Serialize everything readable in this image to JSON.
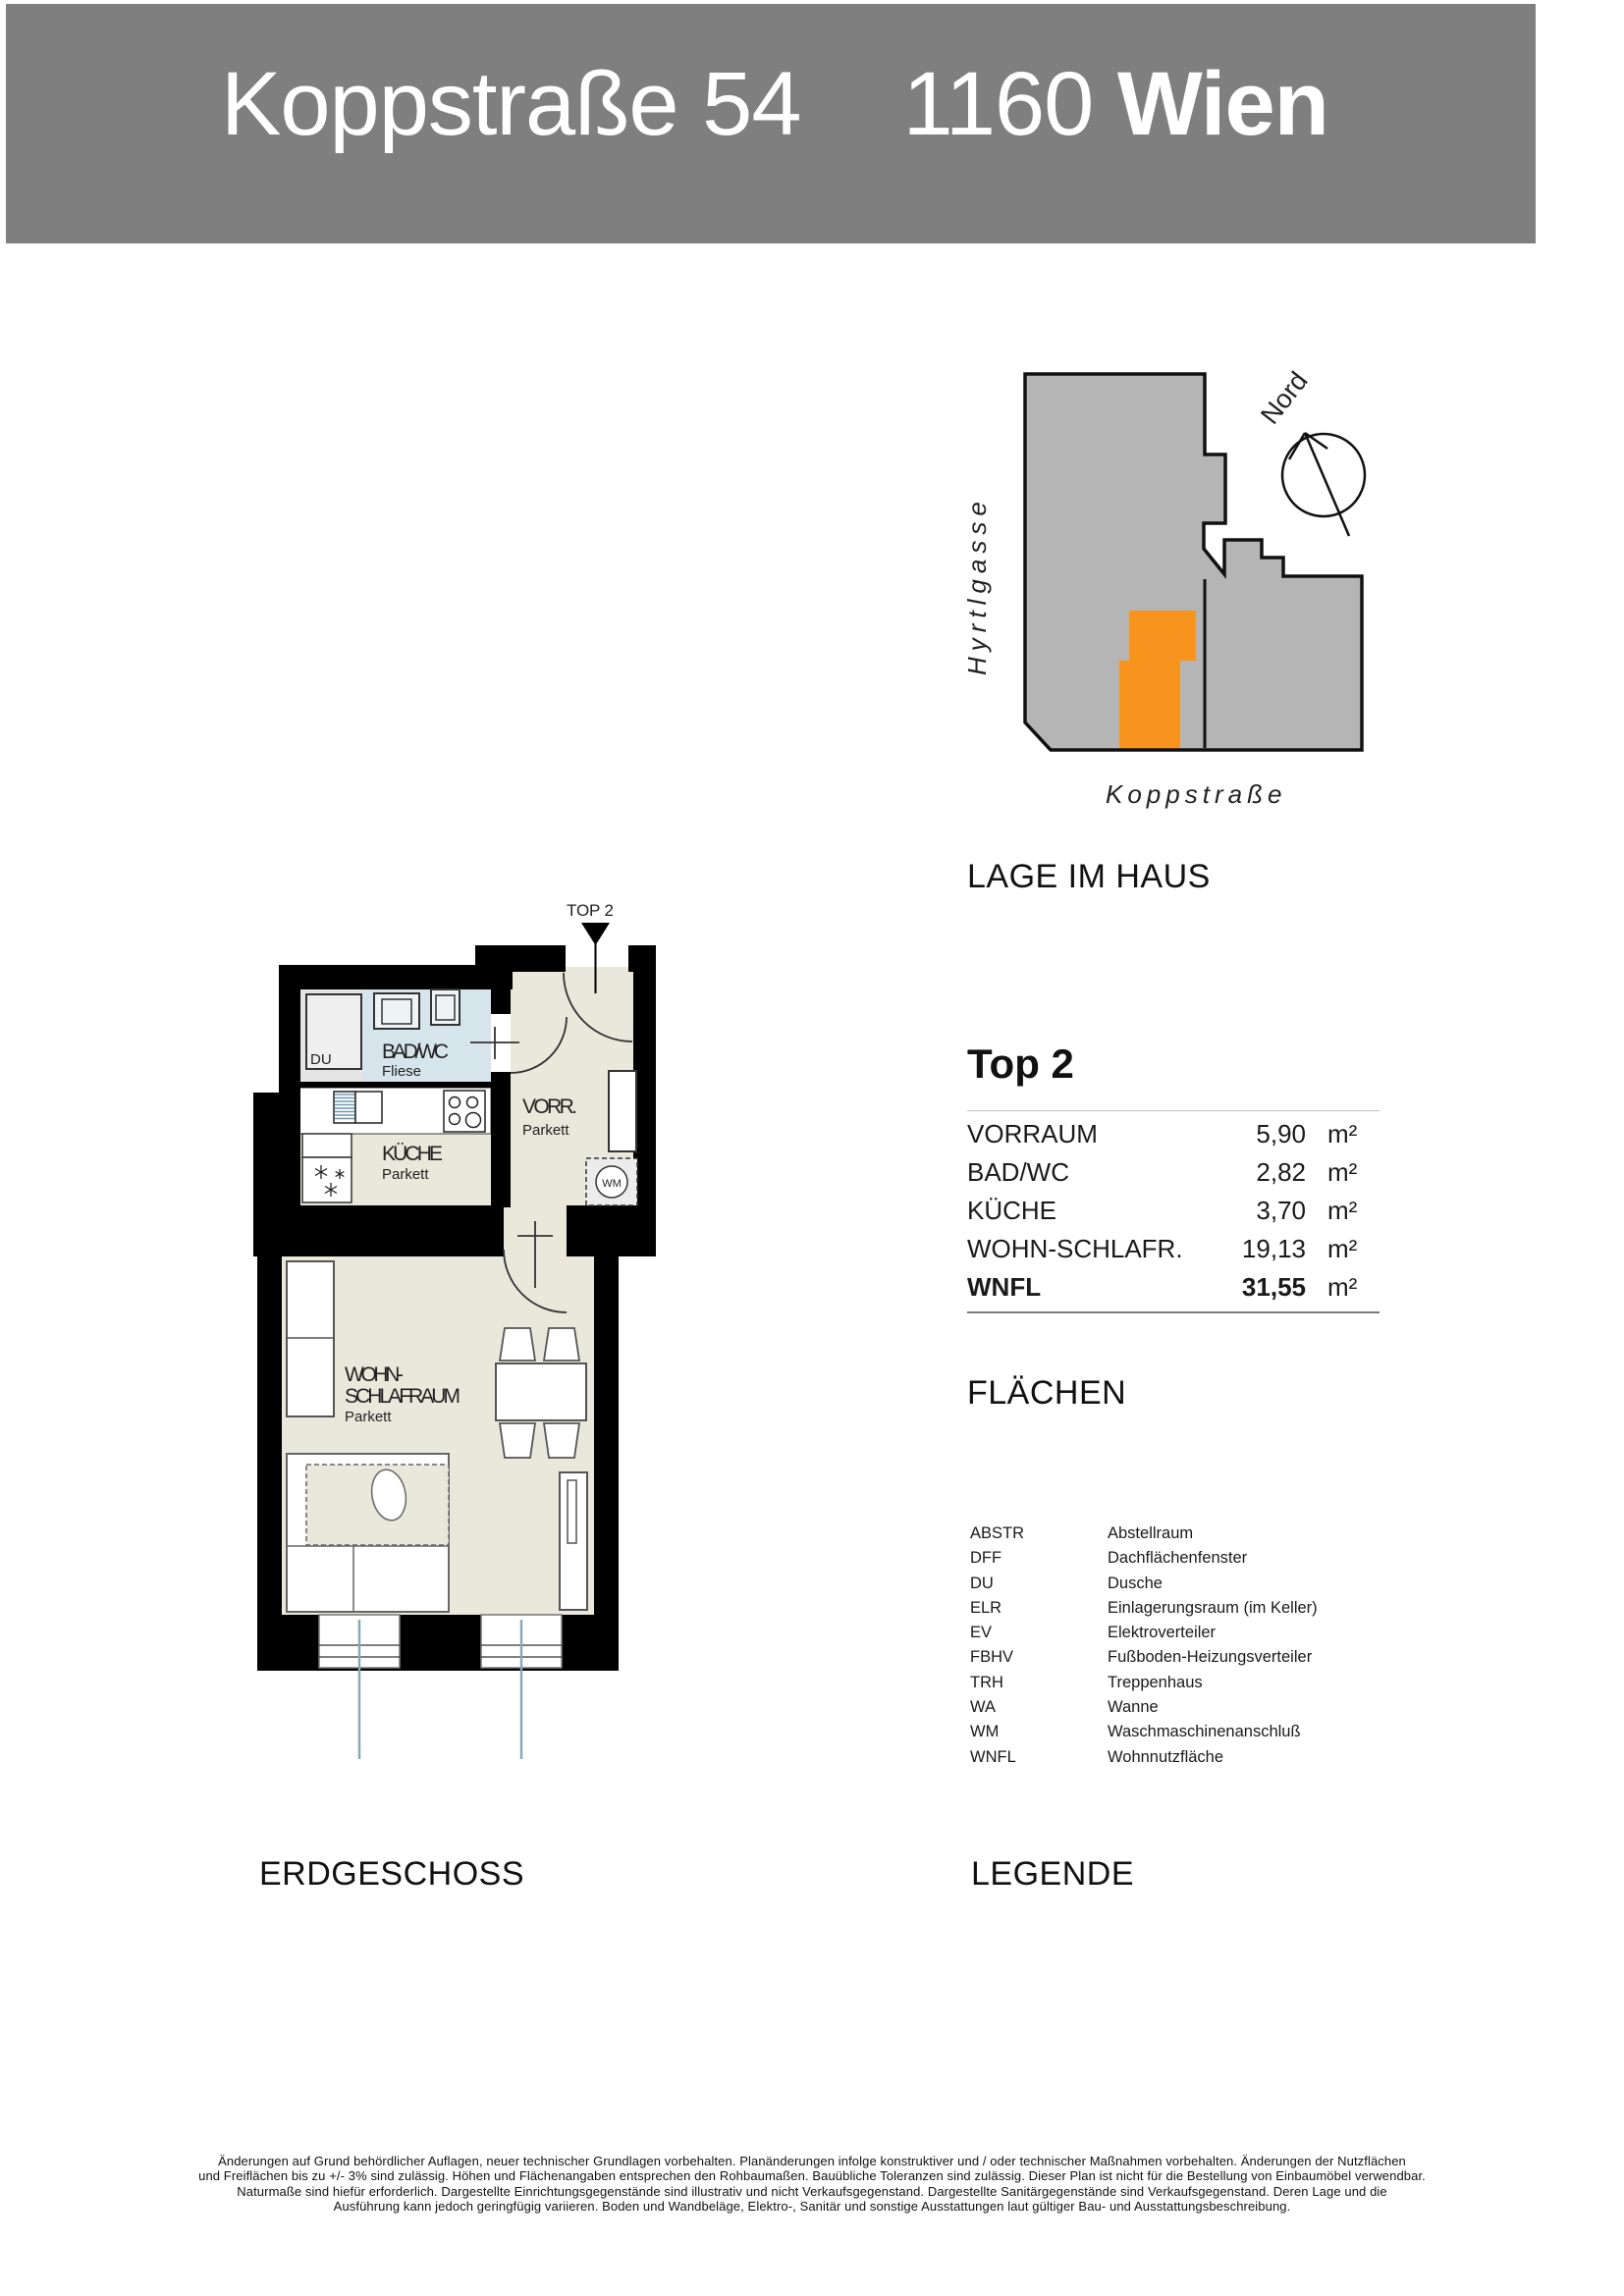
{
  "header": {
    "street": "Koppstraße 54",
    "postal": "1160",
    "city_bold": "Wien"
  },
  "site_plan": {
    "heading": "LAGE IM HAUS",
    "street_left": "Hyrtlgasse",
    "street_bottom": "Koppstraße",
    "compass_label": "Nord",
    "building_color": "#b5b5b5",
    "unit_color": "#f7941e"
  },
  "unit": {
    "title": "Top 2",
    "areas_heading": "FLÄCHEN",
    "rows": [
      {
        "name": "VORRAUM",
        "value": "5,90",
        "unit": "m²"
      },
      {
        "name": "BAD/WC",
        "value": "2,82",
        "unit": "m²"
      },
      {
        "name": "KÜCHE",
        "value": "3,70",
        "unit": "m²"
      },
      {
        "name": "WOHN-SCHLAFR.",
        "value": "19,13",
        "unit": "m²"
      },
      {
        "name": "WNFL",
        "value": "31,55",
        "unit": "m²"
      }
    ]
  },
  "legend": {
    "heading": "LEGENDE",
    "items": [
      {
        "abbr": "ABSTR",
        "label": "Abstellraum"
      },
      {
        "abbr": "DFF",
        "label": "Dachflächenfenster"
      },
      {
        "abbr": "DU",
        "label": "Dusche"
      },
      {
        "abbr": "ELR",
        "label": "Einlagerungsraum (im Keller)"
      },
      {
        "abbr": "EV",
        "label": "Elektroverteiler"
      },
      {
        "abbr": "FBHV",
        "label": "Fußboden-Heizungsverteiler"
      },
      {
        "abbr": "TRH",
        "label": "Treppenhaus"
      },
      {
        "abbr": "WA",
        "label": "Wanne"
      },
      {
        "abbr": "WM",
        "label": "Waschmaschinenanschluß"
      },
      {
        "abbr": "WNFL",
        "label": "Wohnnutzfläche"
      }
    ]
  },
  "floor_plan": {
    "floor_label": "ERDGESCHOSS",
    "unit_marker": "TOP 2",
    "rooms": {
      "bad_name": "BAD/WC",
      "bad_floor": "Fliese",
      "du": "DU",
      "kueche_name": "KÜCHE",
      "kueche_floor": "Parkett",
      "vorraum_name": "VORR.",
      "vorraum_floor": "Parkett",
      "wohn_line1": "WOHN-",
      "wohn_line2": "SCHLAFRAUM",
      "wohn_floor": "Parkett",
      "wm": "WM"
    },
    "colors": {
      "floor_beige": "#eae7db",
      "floor_tile_blue": "#d6e4ec"
    }
  },
  "footer": {
    "lines": [
      "Änderungen auf Grund behördlicher Auflagen, neuer technischer Grundlagen vorbehalten. Planänderungen infolge konstruktiver und / oder technischer Maßnahmen vorbehalten. Änderungen der Nutzflächen",
      "und Freiflächen bis zu +/- 3% sind zulässig. Höhen und Flächenangaben entsprechen den Rohbaumaßen. Bauübliche Toleranzen sind zulässig. Dieser Plan ist nicht für die Bestellung von Einbaumöbel verwendbar.",
      "Naturmaße sind hiefür erforderlich. Dargestellte Einrichtungsgegenstände sind illustrativ und nicht Verkaufsgegenstand.  Dargestellte Sanitärgegenstände sind Verkaufsgegenstand.   Deren Lage und die",
      "Ausführung kann jedoch geringfügig variieren. Boden und Wandbeläge, Elektro-, Sanitär und sonstige Ausstattungen laut gültiger Bau- und Ausstattungsbeschreibung."
    ]
  }
}
